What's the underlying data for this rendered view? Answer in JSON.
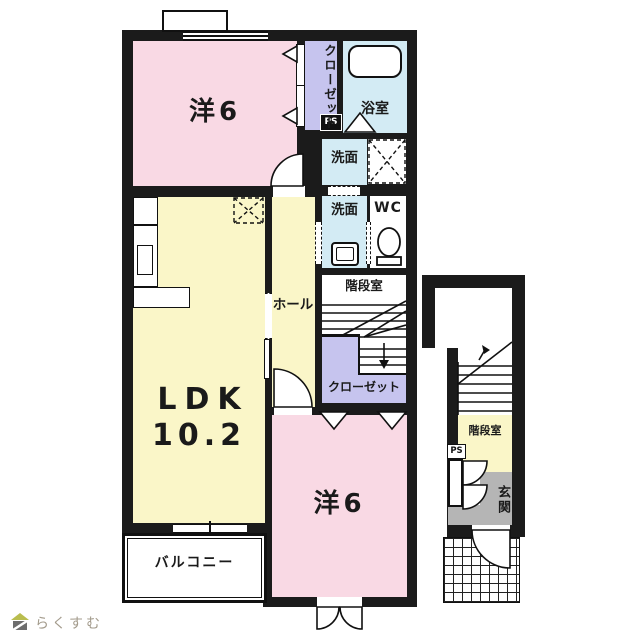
{
  "branding": {
    "logo_text": "らくすむ",
    "logo_icon": "house-icon"
  },
  "palette": {
    "wall": "#1b1b1b",
    "room_pink": "#f9d9e4",
    "room_yellow": "#faf6c8",
    "room_blue": "#d3ebf4",
    "room_lavender": "#c6c4ee",
    "entrance_gray": "#b5b5b5",
    "background": "#ffffff",
    "logo_text_color": "#a39b8c",
    "logo_roof_color": "#b9bd4f"
  },
  "labels": {
    "bedroom_top": "洋6",
    "closet_top": "クローゼット",
    "ps_main": "PS",
    "bathroom": "浴室",
    "washroom_upper": "洗面",
    "washroom_lower": "洗面",
    "wc": "WC",
    "stairwell_main": "階段室",
    "hall": "ホール",
    "closet_mid": "クローゼット",
    "ldk_line1": "LDK",
    "ldk_line2": "10.2",
    "bedroom_bottom": "洋6",
    "balcony": "バルコニー",
    "stairwell_annex": "階段室",
    "ps_annex": "PS",
    "entrance": "玄関",
    "logo": "らくすむ"
  }
}
